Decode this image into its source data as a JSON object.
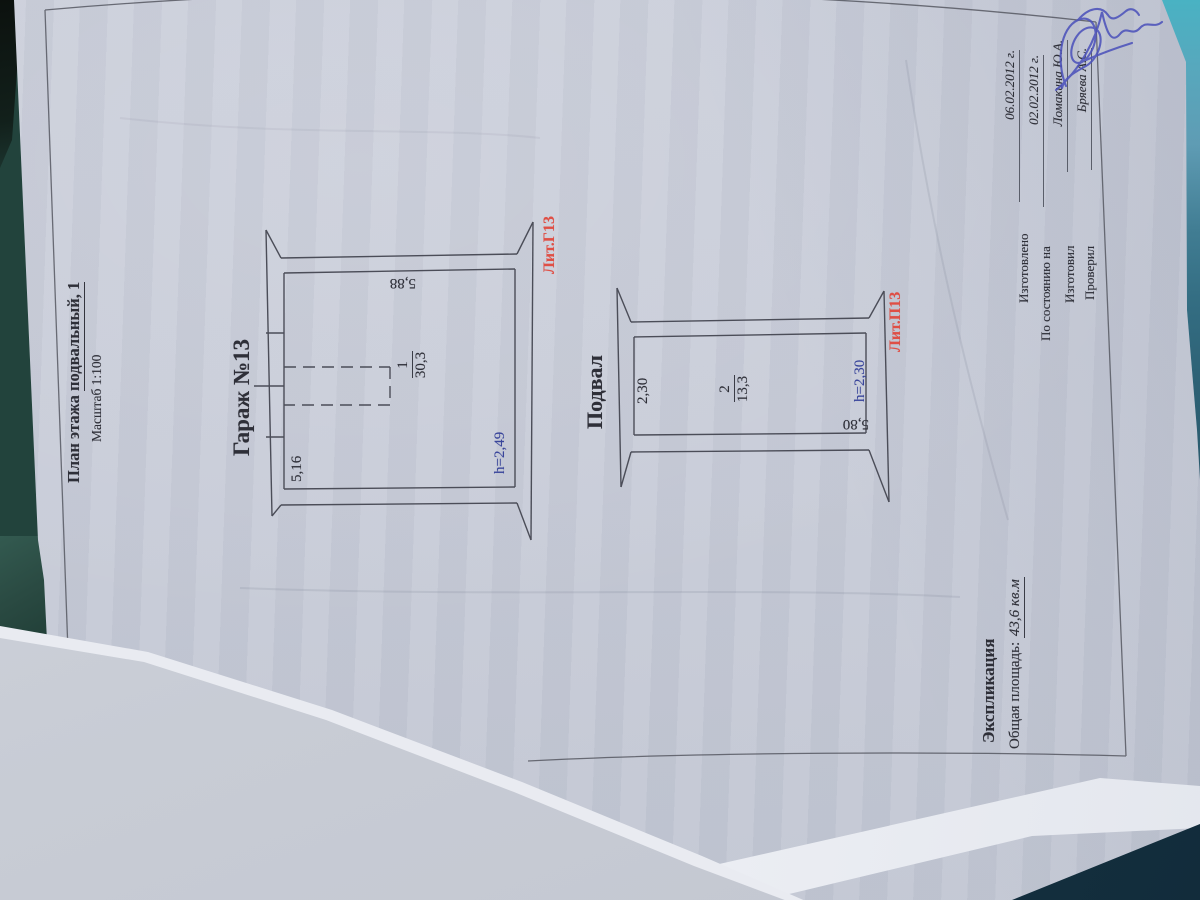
{
  "colors": {
    "paper": "#c9cdd9",
    "ink": "#2e2f38",
    "blue_ink": "#39459b",
    "red_ink": "#df4f45",
    "signature_blue": "#4d53bb",
    "background_teal": "#3a7489",
    "background_navy": "#17384a"
  },
  "title": {
    "prefix": "План этажа ",
    "underlined": "подвальный, 1",
    "scale": "Масштаб 1:100"
  },
  "garage": {
    "label": "Гараж №13",
    "room_number": "1",
    "room_area": "30,3",
    "dim_depth": "5,16",
    "dim_width": "5,88",
    "ceiling_height": "h=2,49",
    "liter": "Лит.Г13"
  },
  "basement": {
    "label": "Подвал",
    "room_number": "2",
    "room_area": "13,3",
    "dim_depth": "2,30",
    "dim_width": "5,80",
    "ceiling_height": "h=2,30",
    "liter": "Лит.П13"
  },
  "explication": {
    "heading": "Экспликация",
    "total_area_label": "Общая площадь:",
    "total_area_value": "43,6 кв.м"
  },
  "stamp": {
    "rows": [
      {
        "label": "Изготовлено",
        "value": "06.02.2012 г."
      },
      {
        "label": "По состоянию на",
        "value": "02.02.2012 г."
      },
      {
        "label": "Изготовил",
        "value": "Ломакина Ю.А."
      },
      {
        "label": "Проверил",
        "value": "Бряева А.С."
      }
    ]
  }
}
